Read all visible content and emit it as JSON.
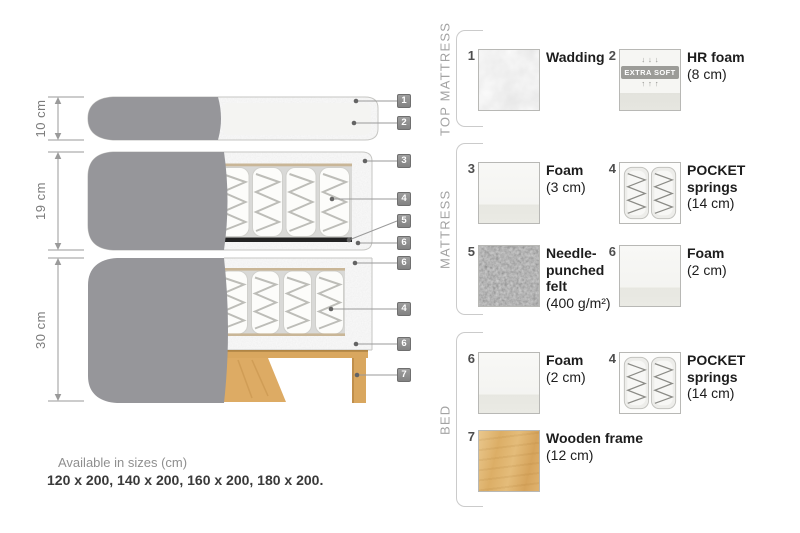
{
  "diagram": {
    "dimensions": [
      {
        "label": "10 cm"
      },
      {
        "label": "19 cm"
      },
      {
        "label": "30 cm"
      }
    ],
    "callouts": [
      {
        "num": "1"
      },
      {
        "num": "2"
      },
      {
        "num": "3"
      },
      {
        "num": "4"
      },
      {
        "num": "5"
      },
      {
        "num": "6"
      },
      {
        "num": "6"
      },
      {
        "num": "4"
      },
      {
        "num": "6"
      },
      {
        "num": "7"
      }
    ]
  },
  "legend": {
    "groups": [
      {
        "label": "TOP MATTRESS",
        "items": [
          {
            "num": "1",
            "swatch": "wadding",
            "name_lines": [
              "Wadding"
            ],
            "size": ""
          },
          {
            "num": "2",
            "swatch": "hr-foam",
            "arrows_down": "↓↓↓",
            "extra_soft": "EXTRA SOFT",
            "arrows_up": "↑↑↑",
            "name_lines": [
              "HR foam"
            ],
            "size": "(8 cm)"
          }
        ]
      },
      {
        "label": "MATTRESS",
        "items": [
          {
            "num": "3",
            "swatch": "foam",
            "name_lines": [
              "Foam"
            ],
            "size": "(3 cm)"
          },
          {
            "num": "4",
            "swatch": "pocket-springs",
            "name_lines": [
              "POCKET",
              "springs"
            ],
            "size": "(14 cm)"
          },
          {
            "num": "5",
            "swatch": "felt",
            "name_lines": [
              "Needle-",
              "punched",
              "felt"
            ],
            "size": "(400 g/m²)"
          },
          {
            "num": "6",
            "swatch": "foam",
            "name_lines": [
              "Foam"
            ],
            "size": "(2 cm)"
          }
        ]
      },
      {
        "label": "BED",
        "items": [
          {
            "num": "6",
            "swatch": "foam",
            "name_lines": [
              "Foam"
            ],
            "size": "(2 cm)"
          },
          {
            "num": "4",
            "swatch": "pocket-springs",
            "name_lines": [
              "POCKET",
              "springs"
            ],
            "size": "(14 cm)"
          },
          {
            "num": "7",
            "swatch": "wood",
            "name_lines": [
              "Wooden frame"
            ],
            "size": "(12 cm)"
          }
        ]
      }
    ]
  },
  "footer": {
    "sizes_title": "Available in sizes (cm)",
    "sizes_list": "120 x 200, 140 x 200, 160 x 200, 180 x 200."
  },
  "colors": {
    "fabric_gray": "#96969a",
    "foam_speckle": "#e6e6e4",
    "tan_layer": "#c9b697",
    "felt_black": "#222222",
    "wood": "#d9a75f",
    "callout_bg": "#8d8d8d",
    "text_dark": "#1d1d1d",
    "text_gray": "#8f8f8f"
  }
}
